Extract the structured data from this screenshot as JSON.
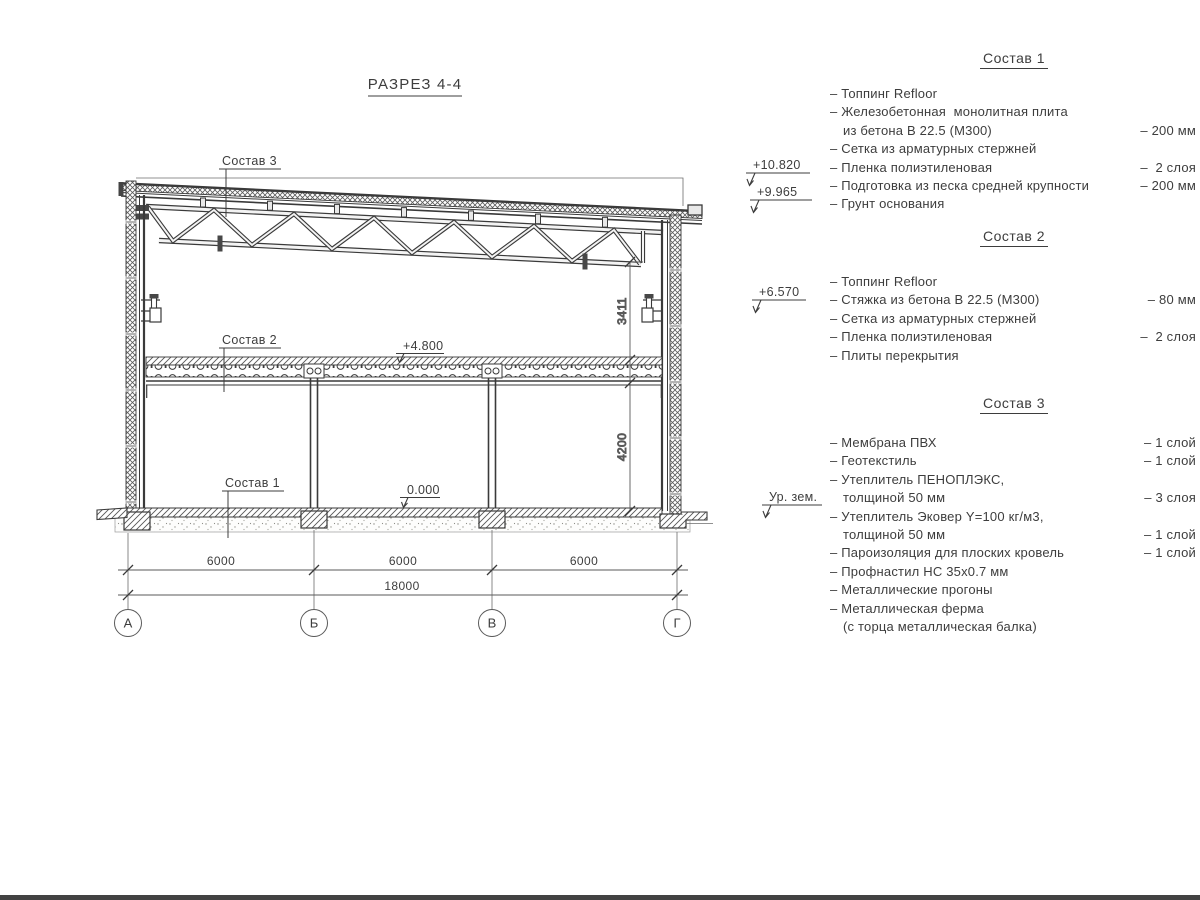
{
  "title": "РАЗРЕЗ 4-4",
  "drawing": {
    "layer_labels": {
      "sostav3": "Состав 3",
      "sostav2": "Состав 2",
      "sostav1": "Состав 1"
    },
    "elevations": {
      "roof_high": "+10.820",
      "roof_low": "+9.965",
      "bracket": "+6.570",
      "ground": "Ур. зем.",
      "floor": "+4.800",
      "zero": "0.000"
    },
    "dimensions": {
      "truss_height": "3411",
      "floor_height": "4200",
      "spans": [
        "6000",
        "6000",
        "6000"
      ],
      "total": "18000"
    },
    "axes": [
      "А",
      "Б",
      "В",
      "Г"
    ]
  },
  "legend": {
    "sections": [
      {
        "heading": "Состав 1",
        "items": [
          {
            "text": "– Топпинг Refloor",
            "value": ""
          },
          {
            "text": "– Железобетонная  монолитная плита",
            "value": ""
          },
          {
            "text": "из бетона В 22.5 (М300)",
            "value": "– 200 мм"
          },
          {
            "text": "– Сетка из арматурных стержней",
            "value": ""
          },
          {
            "text": "– Пленка полиэтиленовая",
            "value": "–  2 слоя"
          },
          {
            "text": "– Подготовка из песка средней крупности",
            "value": "– 200 мм"
          },
          {
            "text": "– Грунт основания",
            "value": ""
          }
        ]
      },
      {
        "heading": "Состав 2",
        "items": [
          {
            "text": "– Топпинг Refloor",
            "value": ""
          },
          {
            "text": "– Стяжка из бетона В 22.5 (М300)",
            "value": "– 80 мм"
          },
          {
            "text": "– Сетка из арматурных стержней",
            "value": ""
          },
          {
            "text": "– Пленка полиэтиленовая",
            "value": "–  2 слоя"
          },
          {
            "text": "– Плиты перекрытия",
            "value": ""
          }
        ]
      },
      {
        "heading": "Состав 3",
        "items": [
          {
            "text": "– Мембрана ПВХ",
            "value": "– 1 слой"
          },
          {
            "text": "– Геотекстиль",
            "value": "– 1 слой"
          },
          {
            "text": "– Утеплитель ПЕНОПЛЭКС,",
            "value": ""
          },
          {
            "text": "толщиной 50 мм",
            "value": "– 3 слоя"
          },
          {
            "text": "– Утеплитель Эковер Y=100 кг/м3,",
            "value": ""
          },
          {
            "text": "толщиной 50 мм",
            "value": "– 1 слой"
          },
          {
            "text": "– Пароизоляция для плоских кровель",
            "value": "– 1 слой"
          },
          {
            "text": "– Профнастил НС 35х0.7 мм",
            "value": ""
          },
          {
            "text": "– Металлические прогоны",
            "value": ""
          },
          {
            "text": "– Металлическая ферма",
            "value": ""
          },
          {
            "text": "(с торца металлическая балка)",
            "value": ""
          }
        ]
      }
    ]
  }
}
